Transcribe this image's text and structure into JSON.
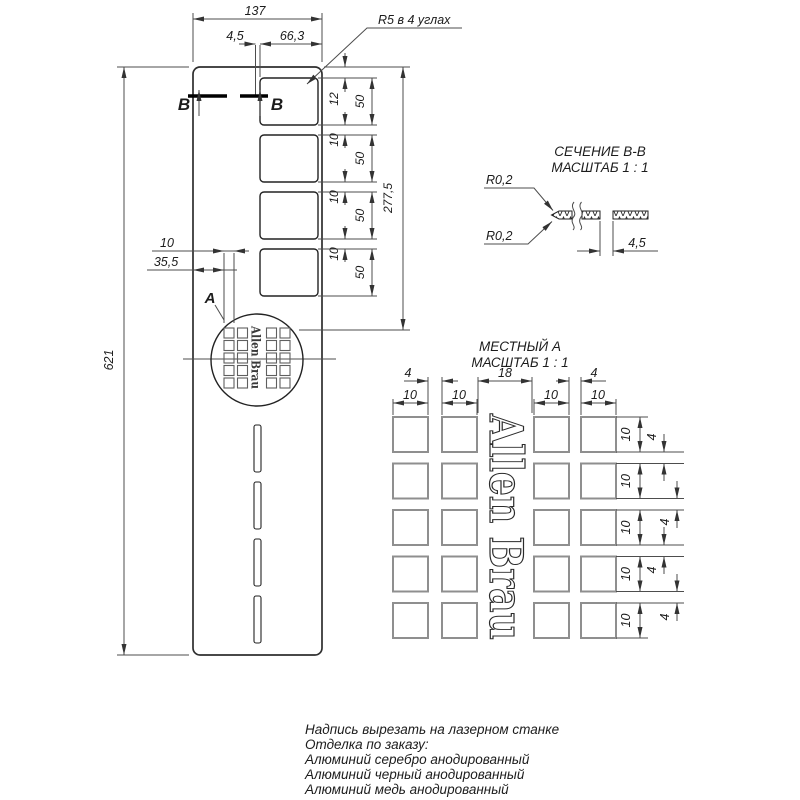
{
  "drawing": {
    "main": {
      "dim_width": "137",
      "dim_edge": "4,5",
      "dim_slot_width": "66,3",
      "corner_note": "R5 в 4 углах",
      "dim_height": "621",
      "dim_top_gap": "12",
      "slot_heights": [
        "50",
        "50",
        "50",
        "50"
      ],
      "slot_gaps": [
        "10",
        "10",
        "10"
      ],
      "dim_span": "277,5",
      "dim_logo_square": "10",
      "dim_logo_offset": "35,5",
      "detail_label": "A",
      "section_label": "B",
      "logo_text": "Allen Brau"
    },
    "section": {
      "title": "СЕЧЕНИЕ В-В",
      "scale": "МАСШТАБ 1 : 1",
      "radius_top": "R0,2",
      "radius_bottom": "R0,2",
      "dim_gap": "4,5"
    },
    "detail": {
      "title": "МЕСТНЫЙ А",
      "scale": "МАСШТАБ 1 : 1",
      "logo_text": "Allen Brau",
      "top_gap_dims": [
        "4",
        "18",
        "4"
      ],
      "col_width_dims": [
        "10",
        "10",
        "10",
        "10"
      ],
      "row_height_dims": [
        "10",
        "10",
        "10",
        "10",
        "10"
      ],
      "row_gap_dims": [
        "4",
        "4",
        "4",
        "4"
      ]
    },
    "notes": [
      "Надпись вырезать на лазерном станке",
      "Отделка по заказу:",
      "Алюминий серебро анодированный",
      "Алюминий черный анодированный",
      "Алюминий медь анодированный"
    ]
  }
}
